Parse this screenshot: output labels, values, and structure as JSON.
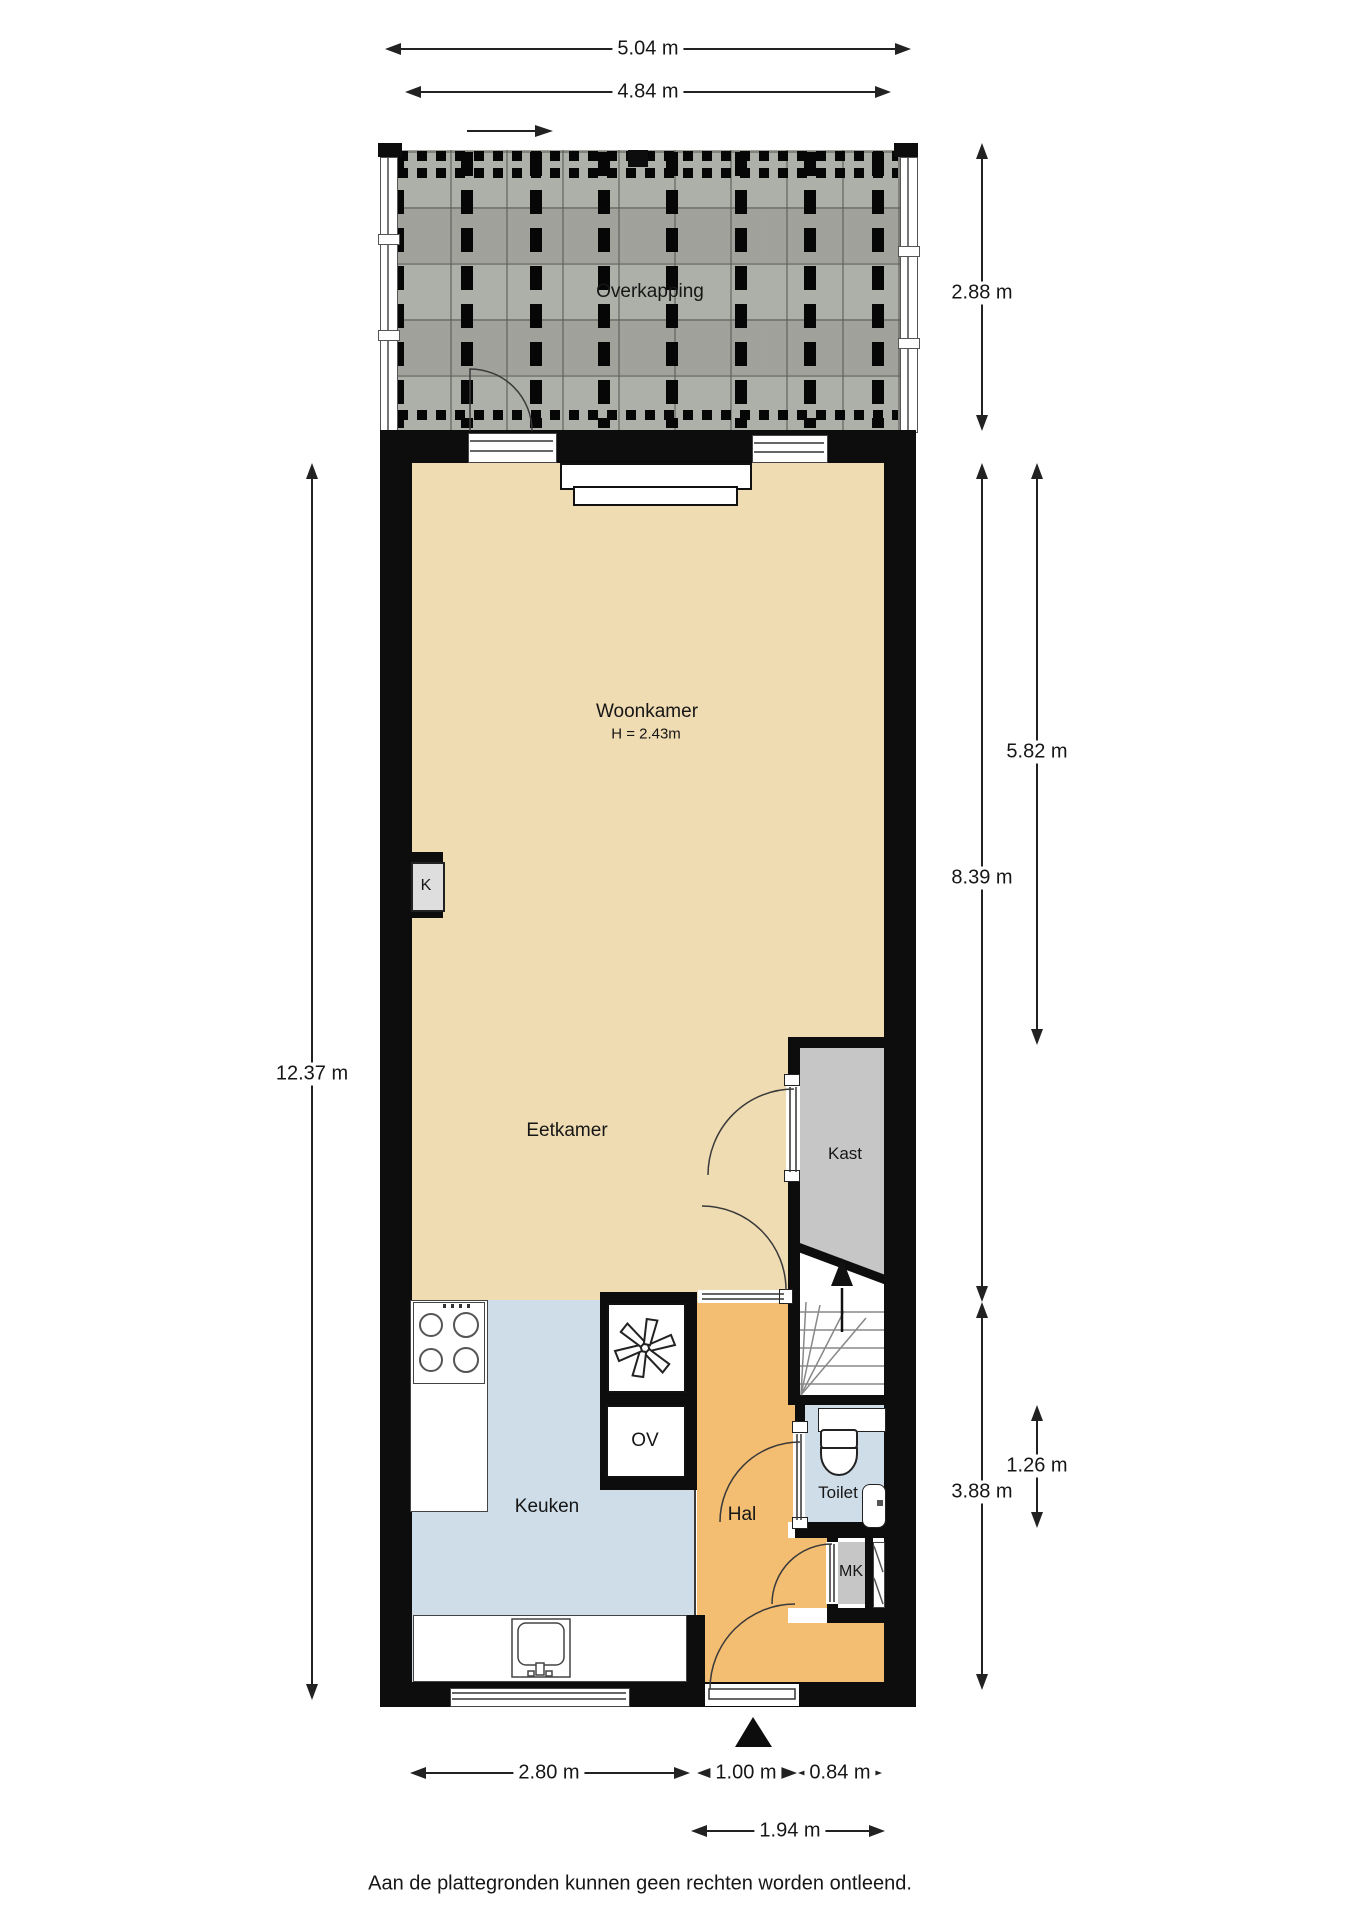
{
  "rooms": {
    "overkapping": "Overkapping",
    "woonkamer": "Woonkamer",
    "woonkamer_ceiling_height": "H = 2.43m",
    "eetkamer": "Eetkamer",
    "kast": "Kast",
    "keuken": "Keuken",
    "hal": "Hal",
    "toilet": "Toilet",
    "meterkast": "MK",
    "oven": "OV",
    "kolom": "K"
  },
  "dimensions": {
    "total_width": "5.04 m",
    "inner_width": "4.84 m",
    "overkapping_depth": "2.88 m",
    "woonkamer_depth": "5.82 m",
    "woon_keuken_depth": "8.39 m",
    "total_depth": "12.37 m",
    "keuken_width": "2.80 m",
    "hal_width": "1.00 m",
    "entree_width": "0.84 m",
    "hal_total_width": "1.94 m",
    "toilet_depth": "1.26 m",
    "keuken_depth": "3.88 m"
  },
  "icons": {
    "entrance_arrow": "filled triangle pointing up at front door",
    "direction_arrow": "right arrow above canopy",
    "extractor_fan": "six-blade fan symbol",
    "stairs_up_arrow": "arrow pointing up over stairs"
  },
  "footer": {
    "disclaimer": "Aan de plattegronden kunnen geen rechten worden ontleend."
  }
}
